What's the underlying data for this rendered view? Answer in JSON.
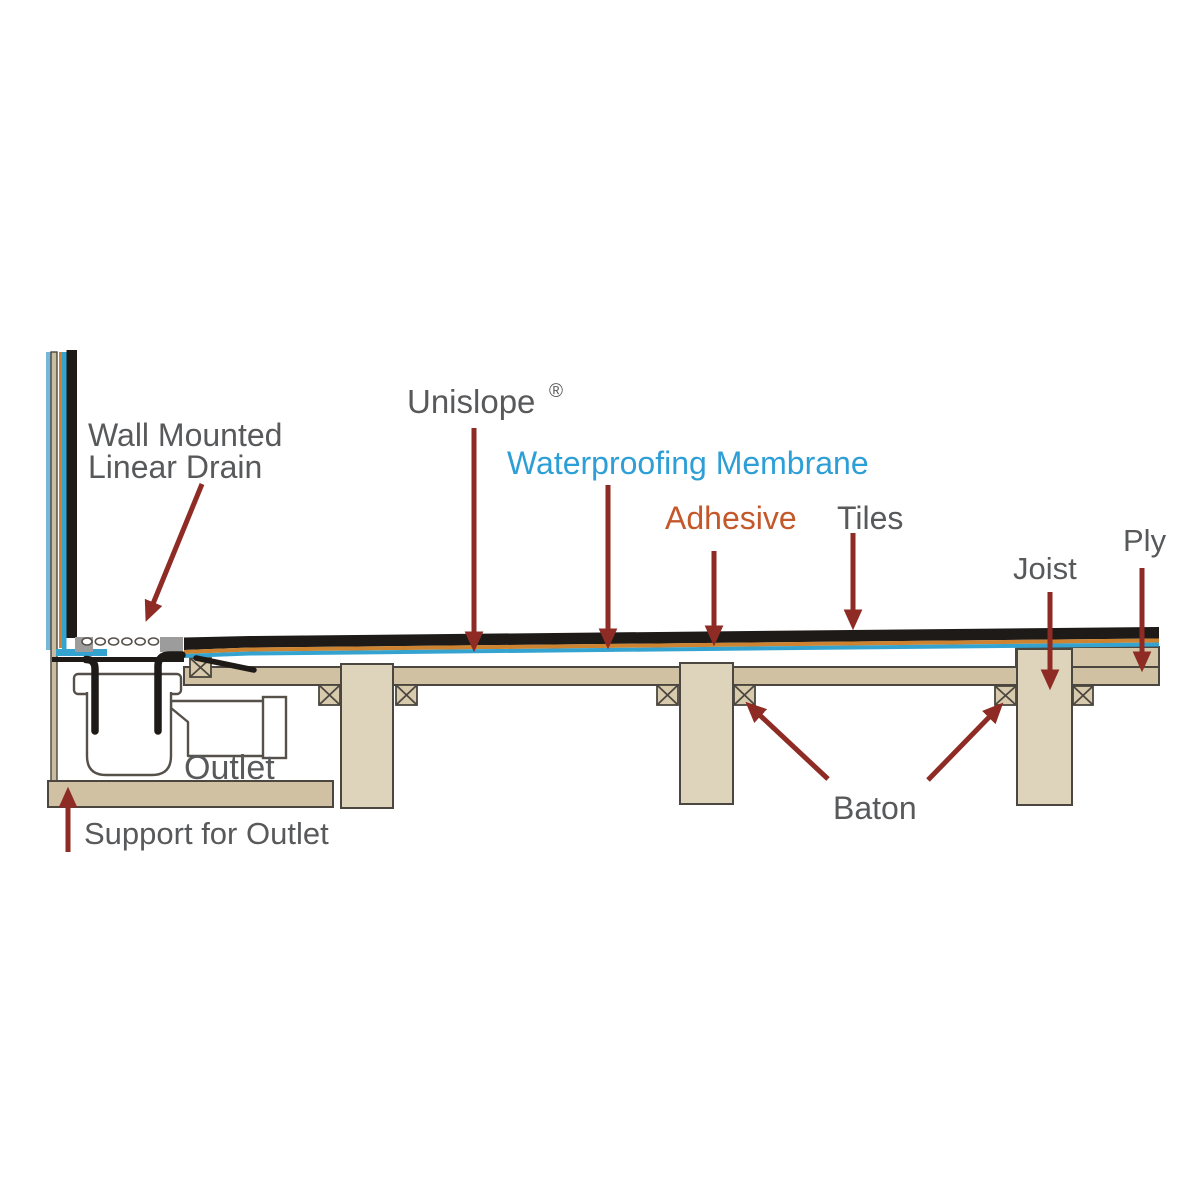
{
  "figure": {
    "description": "Cross-section construction diagram of a wall mounted linear shower drain in a timber floor",
    "background": "#ffffff"
  },
  "labels": {
    "wall_drain": {
      "line1": "Wall Mounted",
      "line2": "Linear Drain",
      "color": "#58595b"
    },
    "unislope": {
      "text": "Unislope",
      "mark": "®",
      "color": "#58595b"
    },
    "membrane": {
      "text": "Waterproofing Membrane",
      "color": "#2d9fd6"
    },
    "adhesive": {
      "text": "Adhesive",
      "color": "#c4582a"
    },
    "tiles": {
      "text": "Tiles",
      "color": "#58595b"
    },
    "joist": {
      "text": "Joist",
      "color": "#58595b"
    },
    "ply": {
      "text": "Ply",
      "color": "#58595b"
    },
    "baton": {
      "text": "Baton",
      "color": "#58595b"
    },
    "outlet": {
      "text": "Outlet",
      "color": "#58595b"
    },
    "support": {
      "text": "Support for Outlet",
      "color": "#58595b"
    }
  },
  "colors": {
    "arrow_red": "#8e2b24",
    "tile_black": "#1d1a17",
    "adhesive_orange": "#cd832f",
    "membrane_blue": "#35a3d0",
    "wall_outer_blue": "#79b7d9",
    "wood_tan": "#cfc1a1",
    "joist_tan": "#ded3bb",
    "unislope_end_tan": "#d3c5a5",
    "baton_tan": "#d8cbad",
    "flange_gray": "#9c9c9c",
    "outline": "#4b463f",
    "label_gray": "#58595b"
  }
}
